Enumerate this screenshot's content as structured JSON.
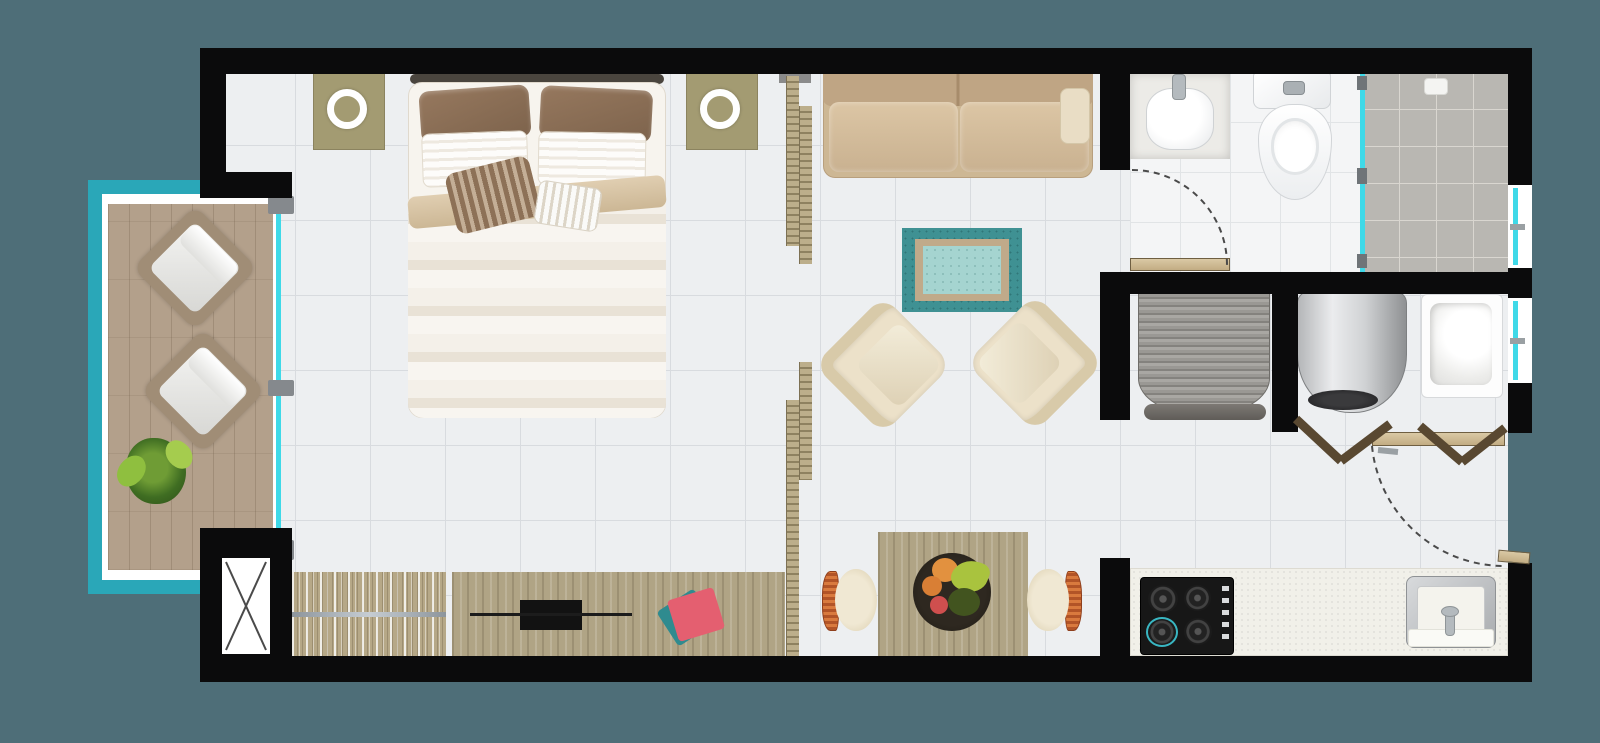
{
  "scene": {
    "name": "studio-apartment-floor-plan",
    "width": 1600,
    "height": 743,
    "background": "#4e6e78",
    "palette": {
      "wall": "#0b0b0c",
      "floor_tile": "#edeff1",
      "balcony_rail_teal": "#2aa7b8",
      "glass_cyan": "#3fd9e8",
      "deck_wood": "#b3a08b",
      "furniture_wood": "#b0a485",
      "sofa_tan": "#cdb794",
      "armchair_cream": "#ece1c9",
      "rug_teal": "#3f9193",
      "shower_tile": "#b9b7b2",
      "kitchen_counter": "#f1f0e9",
      "accent_pink": "#e45f70"
    }
  },
  "elements": [
    {
      "name": "floor-main",
      "cls": "tile",
      "x": 220,
      "y": 70,
      "w": 1288,
      "h": 590
    },
    {
      "name": "floor-bathroom",
      "cls": "bathtile",
      "x": 1130,
      "y": 72,
      "w": 232,
      "h": 202
    },
    {
      "name": "floor-shower",
      "cls": "showertile",
      "x": 1362,
      "y": 72,
      "w": 146,
      "h": 200
    },
    {
      "name": "balcony-underlay",
      "cls": "whiteu",
      "x": 100,
      "y": 192,
      "w": 178,
      "h": 392
    },
    {
      "name": "balcony-rail-left",
      "cls": "teal",
      "x": 88,
      "y": 180,
      "w": 14,
      "h": 414
    },
    {
      "name": "balcony-rail-top",
      "cls": "teal",
      "x": 88,
      "y": 180,
      "w": 118,
      "h": 14
    },
    {
      "name": "balcony-rail-bottom",
      "cls": "teal",
      "x": 88,
      "y": 580,
      "w": 118,
      "h": 14
    },
    {
      "name": "balcony-deck",
      "cls": "deck",
      "x": 108,
      "y": 204,
      "w": 165,
      "h": 366
    },
    {
      "name": "balcony-lounge-chair-1",
      "cls": "lounge",
      "x": 151,
      "y": 224,
      "w": 88,
      "h": 88,
      "rot": 45
    },
    {
      "name": "balcony-lounge-chair-2",
      "cls": "lounge",
      "x": 159,
      "y": 347,
      "w": 88,
      "h": 88,
      "rot": 45
    },
    {
      "name": "balcony-plant",
      "cls": "plant",
      "x": 126,
      "y": 438,
      "w": 60,
      "h": 66
    },
    {
      "name": "balcony-door-glass",
      "cls": "glassline",
      "x": 276,
      "y": 202,
      "w": 5,
      "h": 356
    },
    {
      "name": "balcony-door-frame-top",
      "cls": "grayframe",
      "x": 268,
      "y": 196,
      "w": 26,
      "h": 18
    },
    {
      "name": "balcony-door-frame-mid",
      "cls": "grayframe",
      "x": 268,
      "y": 380,
      "w": 26,
      "h": 16
    },
    {
      "name": "balcony-door-frame-bottom",
      "cls": "grayframe",
      "x": 266,
      "y": 540,
      "w": 28,
      "h": 20
    },
    {
      "name": "nightstand-left",
      "cls": "khaki",
      "x": 313,
      "y": 72,
      "w": 72,
      "h": 78
    },
    {
      "name": "lamp-ring-left",
      "cls": "ring",
      "x": 327,
      "y": 89,
      "w": 40,
      "h": 40
    },
    {
      "name": "nightstand-right",
      "cls": "khaki",
      "x": 686,
      "y": 72,
      "w": 72,
      "h": 78
    },
    {
      "name": "lamp-ring-right",
      "cls": "ring",
      "x": 700,
      "y": 89,
      "w": 40,
      "h": 40
    },
    {
      "name": "bed-headboard",
      "x": 410,
      "y": 74,
      "w": 254,
      "h": 10,
      "bg": "#4a453e",
      "r": 5,
      "z": 3
    },
    {
      "name": "bed-base",
      "cls": "bedbase",
      "x": 408,
      "y": 82,
      "w": 258,
      "h": 336,
      "r": 14
    },
    {
      "name": "bed-pillow-brown-left",
      "cls": "pbrown",
      "x": 420,
      "y": 88,
      "w": 110,
      "h": 52,
      "r": 10,
      "rot": -4
    },
    {
      "name": "bed-pillow-brown-right",
      "cls": "pbrown",
      "x": 540,
      "y": 88,
      "w": 112,
      "h": 52,
      "r": 10,
      "rot": 3
    },
    {
      "name": "bed-pillow-white-left",
      "cls": "pwhite",
      "x": 422,
      "y": 132,
      "w": 106,
      "h": 54,
      "r": 8,
      "rot": -2
    },
    {
      "name": "bed-pillow-white-right",
      "cls": "pwhite",
      "x": 538,
      "y": 132,
      "w": 108,
      "h": 54,
      "r": 8,
      "rot": 1
    },
    {
      "name": "bed-duvet",
      "cls": "duvet",
      "x": 408,
      "y": 196,
      "w": 258,
      "h": 222,
      "r": "6px 6px 16px 16px"
    },
    {
      "name": "bed-duvet-fold",
      "cls": "fold",
      "x": 408,
      "y": 186,
      "w": 258,
      "h": 32,
      "rot": -5
    },
    {
      "name": "bed-pillow-accent-striped",
      "cls": "paccent",
      "x": 450,
      "y": 164,
      "w": 86,
      "h": 62,
      "r": 10,
      "rot": -14
    },
    {
      "name": "bed-pillow-white-striped",
      "cls": "pwstripe",
      "x": 536,
      "y": 184,
      "w": 64,
      "h": 44,
      "r": 8,
      "rot": 9
    },
    {
      "name": "wardrobe-console",
      "cls": "clothes",
      "x": 292,
      "y": 572,
      "w": 154,
      "h": 84
    },
    {
      "name": "wardrobe-rod",
      "cls": "rodline",
      "x": 292,
      "y": 612,
      "w": 154,
      "h": 5
    },
    {
      "name": "tv-console",
      "cls": "woodv",
      "x": 452,
      "y": 572,
      "w": 333,
      "h": 84
    },
    {
      "name": "tv",
      "cls": "blackbox",
      "x": 520,
      "y": 600,
      "w": 62,
      "h": 30
    },
    {
      "name": "soundbar",
      "cls": "darkline",
      "x": 470,
      "y": 613,
      "w": 162,
      "h": 3
    },
    {
      "name": "book-teal",
      "x": 664,
      "y": 597,
      "w": 44,
      "h": 41,
      "bg": "#2f8b8f",
      "r": 4,
      "rot": -33,
      "z": 4
    },
    {
      "name": "book-pink",
      "x": 672,
      "y": 593,
      "w": 48,
      "h": 43,
      "bg": "#e45f70",
      "r": 4,
      "rot": -17,
      "z": 5
    },
    {
      "name": "sofa",
      "cls": "sofa",
      "x": 823,
      "y": 66,
      "w": 270,
      "h": 112,
      "r": "4px 4px 12px 12px"
    },
    {
      "name": "sofa-back-cushions",
      "cls": "sofaback",
      "x": 823,
      "y": 66,
      "w": 270,
      "h": 40,
      "r": "4px 4px 8px 8px"
    },
    {
      "name": "sofa-seat-left",
      "cls": "seat",
      "x": 829,
      "y": 102,
      "w": 129,
      "h": 70,
      "r": 10
    },
    {
      "name": "sofa-seat-right",
      "cls": "seat",
      "x": 960,
      "y": 102,
      "w": 129,
      "h": 70,
      "r": 10
    },
    {
      "name": "sofa-arm-pillow",
      "cls": "armpil",
      "x": 1060,
      "y": 88,
      "w": 30,
      "h": 56,
      "r": 8
    },
    {
      "name": "rug-outer",
      "cls": "rugouter",
      "x": 902,
      "y": 228,
      "w": 120,
      "h": 84
    },
    {
      "name": "rug-border",
      "cls": "rugband",
      "x": 915,
      "y": 239,
      "w": 94,
      "h": 62
    },
    {
      "name": "rug-center",
      "cls": "rugcenter",
      "x": 923,
      "y": 246,
      "w": 78,
      "h": 48
    },
    {
      "name": "armchair-left",
      "cls": "armchair",
      "x": 834,
      "y": 316,
      "w": 98,
      "h": 98,
      "rot": 45
    },
    {
      "name": "armchair-right",
      "cls": "armchair flip",
      "x": 986,
      "y": 314,
      "w": 98,
      "h": 98,
      "rot": -45
    },
    {
      "name": "dining-table",
      "cls": "woodv",
      "x": 878,
      "y": 532,
      "w": 150,
      "h": 126
    },
    {
      "name": "fruit-bowl",
      "x": 913,
      "y": 553,
      "w": 78,
      "h": 78,
      "bg": "radial-gradient(circle,#2e2820 60%,#1d1912)",
      "r": "50%",
      "z": 4
    },
    {
      "name": "fruit-orange-1",
      "x": 932,
      "y": 558,
      "w": 26,
      "h": 24,
      "bg": "#e2913f",
      "r": "50%",
      "z": 5
    },
    {
      "name": "fruit-orange-2",
      "x": 922,
      "y": 576,
      "w": 20,
      "h": 20,
      "bg": "#d97f35",
      "r": "50%",
      "z": 5
    },
    {
      "name": "fruit-banana",
      "x": 952,
      "y": 560,
      "w": 36,
      "h": 32,
      "bg": "#a9c33e",
      "r": "70% 30% 60% 40%",
      "rot": 20,
      "z": 5
    },
    {
      "name": "fruit-red",
      "x": 930,
      "y": 596,
      "w": 18,
      "h": 18,
      "bg": "#cf4f4e",
      "r": "50%",
      "z": 5
    },
    {
      "name": "fruit-kiwi",
      "x": 948,
      "y": 588,
      "w": 32,
      "h": 28,
      "bg": "#42541f",
      "r": "50%",
      "z": 5
    },
    {
      "name": "dining-chair-left",
      "cls": "dchair",
      "x": 822,
      "y": 566,
      "w": 56,
      "h": 68
    },
    {
      "name": "dining-chair-right",
      "cls": "dchair",
      "x": 1026,
      "y": 566,
      "w": 56,
      "h": 68,
      "flip": true
    },
    {
      "name": "bath-sink-base",
      "cls": "sinkbase",
      "x": 1130,
      "y": 73,
      "w": 100,
      "h": 86
    },
    {
      "name": "bath-sink-basin",
      "cls": "basin",
      "x": 1146,
      "y": 88,
      "w": 68,
      "h": 62,
      "r": "38%"
    },
    {
      "name": "bath-sink-faucet",
      "cls": "faucet",
      "x": 1172,
      "y": 74,
      "w": 14,
      "h": 26,
      "r": 4
    },
    {
      "name": "toilet-tank",
      "cls": "porcelain",
      "x": 1253,
      "y": 72,
      "w": 78,
      "h": 37,
      "r": "4px 4px 8px 8px"
    },
    {
      "name": "toilet-flush-button",
      "cls": "pbtn",
      "x": 1283,
      "y": 81,
      "w": 22,
      "h": 14,
      "r": 4
    },
    {
      "name": "toilet-bowl",
      "cls": "toiletbowl",
      "x": 1258,
      "y": 104,
      "w": 74,
      "h": 96
    },
    {
      "name": "shower-drain",
      "cls": "draintile",
      "x": 1424,
      "y": 78,
      "w": 24,
      "h": 17,
      "r": 4
    },
    {
      "name": "shower-glass-panel",
      "cls": "glassline",
      "x": 1360,
      "y": 74,
      "w": 5,
      "h": 198
    },
    {
      "name": "shower-glass-hinge-top",
      "cls": "hinge",
      "x": 1357,
      "y": 76,
      "w": 10,
      "h": 14
    },
    {
      "name": "shower-glass-hinge-mid",
      "cls": "hinge",
      "x": 1357,
      "y": 168,
      "w": 10,
      "h": 16
    },
    {
      "name": "shower-glass-hinge-bottom",
      "cls": "hinge",
      "x": 1357,
      "y": 254,
      "w": 10,
      "h": 14
    },
    {
      "name": "laundry-curved-closet",
      "cls": "curtain",
      "x": 1138,
      "y": 293,
      "w": 132,
      "h": 122,
      "r": "0 0 46% 46% / 0 0 30% 30%"
    },
    {
      "name": "laundry-closet-lip",
      "cls": "curtainlip",
      "x": 1144,
      "y": 404,
      "w": 122,
      "h": 16,
      "r": 8
    },
    {
      "name": "water-heater",
      "cls": "heater",
      "x": 1297,
      "y": 291,
      "w": 110,
      "h": 122,
      "r": "12px 12px 48% 48%"
    },
    {
      "name": "water-heater-vent",
      "cls": "vent",
      "x": 1308,
      "y": 390,
      "w": 70,
      "h": 20,
      "r": "50%"
    },
    {
      "name": "laundry-tub",
      "cls": "tub",
      "x": 1421,
      "y": 294,
      "w": 82,
      "h": 104,
      "r": 6
    },
    {
      "name": "kitchen-counter",
      "cls": "counter",
      "x": 1130,
      "y": 568,
      "w": 378,
      "h": 88
    },
    {
      "name": "cooktop",
      "cls": "cooktop",
      "x": 1140,
      "y": 577,
      "w": 94,
      "h": 78,
      "r": 4
    },
    {
      "name": "cooktop-burner-1",
      "cls": "burner",
      "x": 1148,
      "y": 585,
      "w": 30,
      "h": 28
    },
    {
      "name": "cooktop-burner-2",
      "cls": "burner",
      "x": 1184,
      "y": 585,
      "w": 27,
      "h": 26
    },
    {
      "name": "cooktop-burner-3",
      "cls": "burner tealring",
      "x": 1146,
      "y": 617,
      "w": 32,
      "h": 30
    },
    {
      "name": "cooktop-burner-4",
      "cls": "burner",
      "x": 1184,
      "y": 618,
      "w": 28,
      "h": 27
    },
    {
      "name": "cooktop-knobs",
      "cls": "knobs",
      "x": 1222,
      "y": 586,
      "w": 7,
      "h": 56
    },
    {
      "name": "kitchen-sink-frame",
      "cls": "steel",
      "x": 1406,
      "y": 576,
      "w": 90,
      "h": 72,
      "r": 8
    },
    {
      "name": "kitchen-sink-basin",
      "cls": "sinkinner",
      "x": 1417,
      "y": 586,
      "w": 68,
      "h": 48,
      "r": 4
    },
    {
      "name": "kitchen-sink-panel",
      "cls": "whitepanel",
      "x": 1408,
      "y": 629,
      "w": 86,
      "h": 18,
      "r": 3
    },
    {
      "name": "kitchen-faucet",
      "cls": "faucet",
      "x": 1445,
      "y": 610,
      "w": 10,
      "h": 26,
      "r": 4
    },
    {
      "name": "kitchen-faucet-head",
      "cls": "faucet",
      "x": 1441,
      "y": 606,
      "w": 18,
      "h": 11,
      "r": "50%"
    },
    {
      "name": "partition-beam",
      "cls": "beam",
      "x": 779,
      "y": 70,
      "w": 32,
      "h": 13
    },
    {
      "name": "partition-slat-a",
      "cls": "slat",
      "x": 786,
      "y": 76,
      "w": 13,
      "h": 170
    },
    {
      "name": "partition-slat-b",
      "cls": "slat",
      "x": 799,
      "y": 106,
      "w": 13,
      "h": 158
    },
    {
      "name": "partition-slat-c",
      "cls": "slat",
      "x": 799,
      "y": 362,
      "w": 13,
      "h": 118
    },
    {
      "name": "partition-slat-d",
      "cls": "slat",
      "x": 786,
      "y": 400,
      "w": 13,
      "h": 256
    },
    {
      "name": "wall-top",
      "cls": "wall",
      "x": 200,
      "y": 48,
      "w": 1332,
      "h": 26
    },
    {
      "name": "wall-left",
      "cls": "wall",
      "x": 200,
      "y": 48,
      "w": 26,
      "h": 150
    },
    {
      "name": "wall-balcony-jog",
      "cls": "wall",
      "x": 200,
      "y": 172,
      "w": 92,
      "h": 26
    },
    {
      "name": "wall-bottom",
      "cls": "wall",
      "x": 200,
      "y": 656,
      "w": 1332,
      "h": 26
    },
    {
      "name": "wall-right-a",
      "cls": "wall",
      "x": 1508,
      "y": 48,
      "w": 24,
      "h": 137
    },
    {
      "name": "wall-right-b",
      "cls": "wall",
      "x": 1508,
      "y": 268,
      "w": 24,
      "h": 30
    },
    {
      "name": "wall-right-c",
      "cls": "wall",
      "x": 1508,
      "y": 383,
      "w": 24,
      "h": 50
    },
    {
      "name": "wall-right-d",
      "cls": "wall",
      "x": 1508,
      "y": 563,
      "w": 24,
      "h": 119
    },
    {
      "name": "wall-bath-divider-top",
      "cls": "wall",
      "x": 1100,
      "y": 72,
      "w": 30,
      "h": 98
    },
    {
      "name": "wall-bath-divider-mid",
      "cls": "wall",
      "x": 1100,
      "y": 272,
      "w": 30,
      "h": 148
    },
    {
      "name": "wall-kitchen-stub",
      "cls": "wall",
      "x": 1100,
      "y": 558,
      "w": 30,
      "h": 99
    },
    {
      "name": "wall-hall-horizontal",
      "cls": "wall",
      "x": 1100,
      "y": 272,
      "w": 432,
      "h": 22
    },
    {
      "name": "wall-laundry-mid",
      "cls": "wall",
      "x": 1272,
      "y": 294,
      "w": 26,
      "h": 138
    },
    {
      "name": "shaft-block",
      "cls": "wall",
      "x": 200,
      "y": 528,
      "w": 92,
      "h": 152
    },
    {
      "name": "shaft-duct-box",
      "cls": "shaftbox",
      "x": 222,
      "y": 558,
      "w": 48,
      "h": 96
    },
    {
      "name": "window-shower",
      "cls": "window",
      "x": 1508,
      "y": 185,
      "w": 24,
      "h": 83
    },
    {
      "name": "window-laundry",
      "cls": "window",
      "x": 1508,
      "y": 298,
      "w": 24,
      "h": 85
    },
    {
      "name": "bathroom-door-leaf",
      "cls": "doorwood",
      "x": 1130,
      "y": 258,
      "w": 100,
      "h": 13
    },
    {
      "name": "entry-door-leaf",
      "cls": "doorwood",
      "x": 1372,
      "y": 432,
      "w": 133,
      "h": 14
    },
    {
      "name": "entry-door-stub",
      "cls": "doorwood",
      "x": 1498,
      "y": 551,
      "w": 32,
      "h": 12,
      "rot": 5
    }
  ],
  "svg": {
    "lines": [
      {
        "name": "shaft-x-line-1",
        "x1": 226,
        "y1": 562,
        "x2": 266,
        "y2": 650,
        "stroke": "#4a4a4a",
        "w": 2
      },
      {
        "name": "shaft-x-line-2",
        "x1": 266,
        "y1": 562,
        "x2": 226,
        "y2": 650,
        "stroke": "#4a4a4a",
        "w": 2
      },
      {
        "name": "bifold-door-left-a",
        "x1": 1296,
        "y1": 419,
        "x2": 1341,
        "y2": 461,
        "stroke": "#594831",
        "w": 9
      },
      {
        "name": "bifold-door-left-b",
        "x1": 1341,
        "y1": 461,
        "x2": 1390,
        "y2": 424,
        "stroke": "#594831",
        "w": 9
      },
      {
        "name": "bifold-door-right-a",
        "x1": 1420,
        "y1": 426,
        "x2": 1462,
        "y2": 462,
        "stroke": "#594831",
        "w": 9
      },
      {
        "name": "bifold-door-right-b",
        "x1": 1462,
        "y1": 462,
        "x2": 1505,
        "y2": 428,
        "stroke": "#594831",
        "w": 9
      },
      {
        "name": "bifold-handle",
        "x1": 1378,
        "y1": 450,
        "x2": 1398,
        "y2": 452,
        "stroke": "#9aa0a4",
        "w": 6
      }
    ],
    "arcs": [
      {
        "name": "bathroom-door-swing-arc",
        "d": "M 1132 170 A 95 95 0 0 1 1227 265",
        "stroke": "#4a4a4a",
        "w": 2,
        "dash": "6 5"
      },
      {
        "name": "entry-door-swing-arc",
        "d": "M 1372 446 A 133 133 0 0 0 1505 566",
        "stroke": "#4a4a4a",
        "w": 2,
        "dash": "6 5"
      }
    ]
  }
}
